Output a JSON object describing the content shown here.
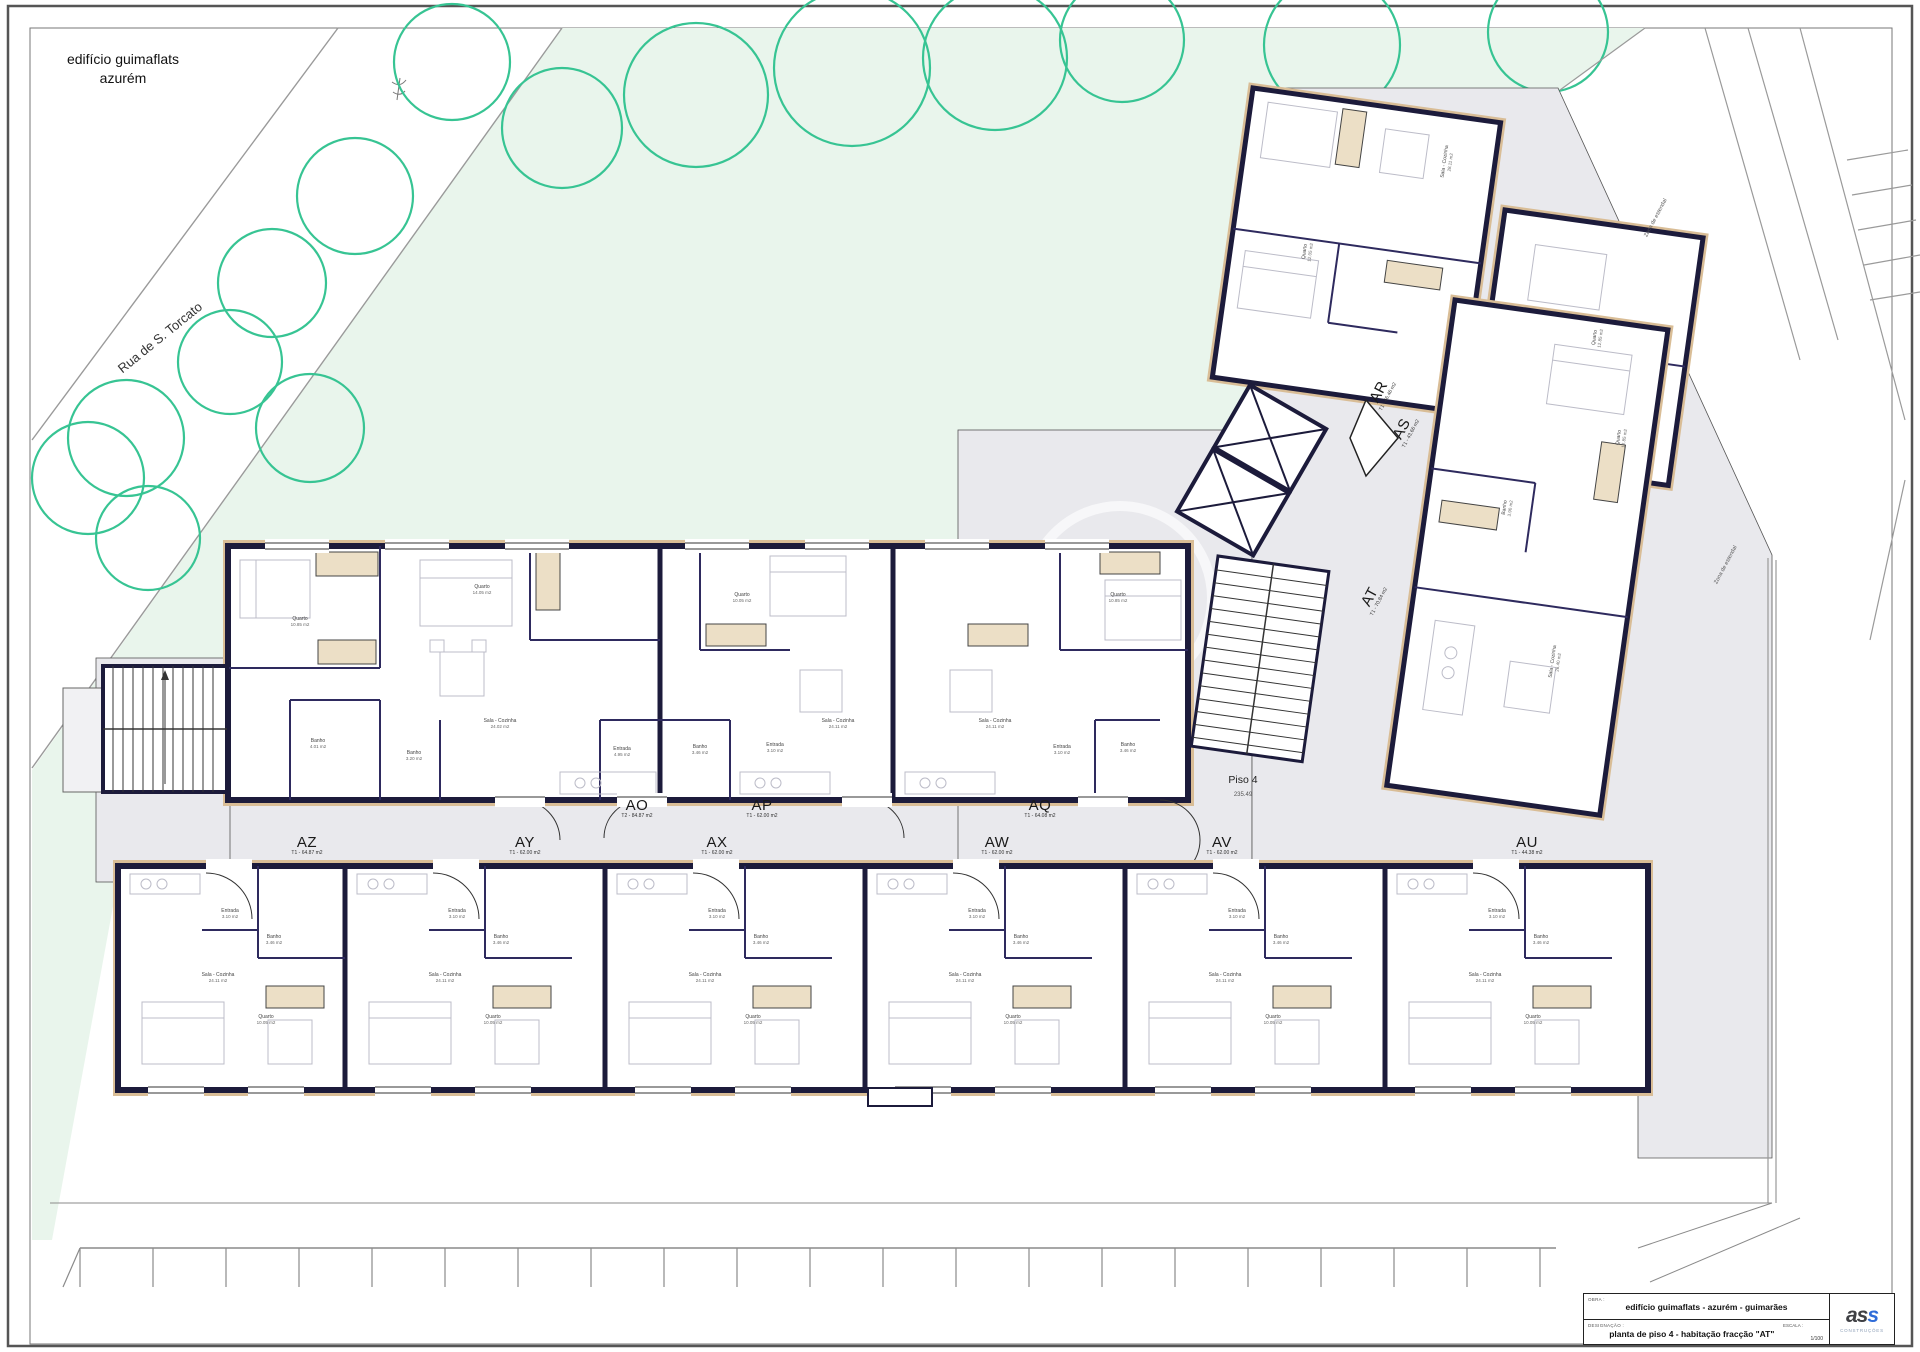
{
  "page": {
    "project_title_line1": "edifício guimaflats",
    "project_title_line2": "azurém",
    "street_name": "Rua de S. Torcato",
    "floor_label": "Piso 4",
    "floor_area": "235.49"
  },
  "colors": {
    "wall": "#1c1b3b",
    "tan": "#d9bd96",
    "gray_deck": "#e9e9ed",
    "green": "#e9f5ec",
    "tree_stroke": "#37c493"
  },
  "units": [
    [
      "AO",
      "T2 - 84.87 m2",
      637,
      808,
      0
    ],
    [
      "AP",
      "T1 - 62.00 m2",
      762,
      808,
      0
    ],
    [
      "AQ",
      "T1 - 64.08 m2",
      1040,
      808,
      0
    ],
    [
      "AZ",
      "T1 - 64.87 m2",
      307,
      845,
      0
    ],
    [
      "AY",
      "T1 - 62.00 m2",
      525,
      845,
      0
    ],
    [
      "AX",
      "T1 - 62.00 m2",
      717,
      845,
      0
    ],
    [
      "AW",
      "T1 - 62.00 m2",
      997,
      845,
      0
    ],
    [
      "AV",
      "T1 - 62.00 m2",
      1222,
      845,
      0
    ],
    [
      "AU",
      "T1 - 44.38 m2",
      1527,
      845,
      0
    ],
    [
      "AR",
      "T1 - 46.46 m2",
      1381,
      393,
      -62
    ],
    [
      "AS",
      "T1 - 43.66 m2",
      1404,
      430,
      -62
    ],
    [
      "AT",
      "T1 - 70.84 m2",
      1372,
      598,
      -62
    ]
  ],
  "rooms": [
    [
      "Quarto",
      "10.85 m2",
      300,
      622,
      0
    ],
    [
      "Quarto",
      "14.05 m2",
      482,
      590,
      0
    ],
    [
      "Sala - Cozinha",
      "24.02 m2",
      500,
      724,
      0
    ],
    [
      "Banho",
      "4.01 m2",
      318,
      744,
      0
    ],
    [
      "Banho",
      "3.20 m2",
      414,
      756,
      0
    ],
    [
      "Entrada",
      "4.95 m2",
      622,
      752,
      0
    ],
    [
      "Quarto",
      "10.05 m2",
      742,
      598,
      0
    ],
    [
      "Sala - Cozinha",
      "24.11 m2",
      838,
      724,
      0
    ],
    [
      "Banho",
      "3.46 m2",
      700,
      750,
      0
    ],
    [
      "Entrada",
      "3.10 m2",
      775,
      748,
      0
    ],
    [
      "Quarto",
      "10.85 m2",
      1118,
      598,
      0
    ],
    [
      "Sala - Cozinha",
      "24.11 m2",
      995,
      724,
      0
    ],
    [
      "Banho",
      "3.46 m2",
      1128,
      748,
      0
    ],
    [
      "Entrada",
      "3.10 m2",
      1062,
      750,
      0
    ],
    [
      "Entrada",
      "3.10 m2",
      230,
      914,
      0
    ],
    [
      "Banho",
      "3.46 m2",
      274,
      940,
      0
    ],
    [
      "Sala - Cozinha",
      "24.11 m2",
      218,
      978,
      0
    ],
    [
      "Quarto",
      "10.05 m2",
      266,
      1020,
      0
    ],
    [
      "Entrada",
      "3.10 m2",
      457,
      914,
      0
    ],
    [
      "Banho",
      "3.46 m2",
      501,
      940,
      0
    ],
    [
      "Sala - Cozinha",
      "24.11 m2",
      445,
      978,
      0
    ],
    [
      "Quarto",
      "10.05 m2",
      493,
      1020,
      0
    ],
    [
      "Entrada",
      "3.10 m2",
      717,
      914,
      0
    ],
    [
      "Banho",
      "3.46 m2",
      761,
      940,
      0
    ],
    [
      "Sala - Cozinha",
      "24.11 m2",
      705,
      978,
      0
    ],
    [
      "Quarto",
      "10.05 m2",
      753,
      1020,
      0
    ],
    [
      "Entrada",
      "3.10 m2",
      977,
      914,
      0
    ],
    [
      "Banho",
      "3.46 m2",
      1021,
      940,
      0
    ],
    [
      "Sala - Cozinha",
      "24.11 m2",
      965,
      978,
      0
    ],
    [
      "Quarto",
      "10.05 m2",
      1013,
      1020,
      0
    ],
    [
      "Entrada",
      "3.10 m2",
      1237,
      914,
      0
    ],
    [
      "Banho",
      "3.46 m2",
      1281,
      940,
      0
    ],
    [
      "Sala - Cozinha",
      "24.11 m2",
      1225,
      978,
      0
    ],
    [
      "Quarto",
      "10.05 m2",
      1273,
      1020,
      0
    ],
    [
      "Entrada",
      "3.10 m2",
      1497,
      914,
      0
    ],
    [
      "Banho",
      "3.46 m2",
      1541,
      940,
      0
    ],
    [
      "Sala - Cozinha",
      "24.11 m2",
      1485,
      978,
      0
    ],
    [
      "Quarto",
      "10.05 m2",
      1533,
      1020,
      0
    ],
    [
      "Sala - Cozinha",
      "28.11 m2",
      1448,
      162,
      -82
    ],
    [
      "Quarto",
      "12.05 m2",
      1308,
      252,
      -82
    ],
    [
      "Quarto",
      "12.85 m2",
      1598,
      338,
      -82
    ],
    [
      "Quarto",
      "12.85 m2",
      1622,
      438,
      -82
    ],
    [
      "Banho",
      "3.90 m2",
      1508,
      508,
      -82
    ],
    [
      "Sala - Cozinha",
      "26.40 m2",
      1556,
      662,
      -82
    ]
  ],
  "terrace_labels": [
    [
      "Zona de estendal",
      1656,
      218
    ],
    [
      "Zona de estendal",
      1726,
      565
    ]
  ],
  "trees": [
    [
      452,
      62,
      58
    ],
    [
      562,
      128,
      60
    ],
    [
      696,
      95,
      72
    ],
    [
      852,
      68,
      78
    ],
    [
      995,
      58,
      72
    ],
    [
      1122,
      40,
      62
    ],
    [
      1332,
      45,
      68
    ],
    [
      1548,
      32,
      60
    ],
    [
      355,
      196,
      58
    ],
    [
      272,
      283,
      54
    ],
    [
      230,
      362,
      52
    ],
    [
      310,
      428,
      54
    ],
    [
      126,
      438,
      58
    ],
    [
      88,
      478,
      56
    ],
    [
      148,
      538,
      52
    ]
  ],
  "title_block": {
    "obra_label": "OBRA :",
    "obra_value": "edifício guimaflats  -  azurém  -  guimarães",
    "designacao_label": "DESIGNAÇÃO :",
    "designacao_value": "planta de piso 4  -  habitação fracção \"AT\"",
    "escala_label": "ESCALA :",
    "escala_value": "1/100",
    "logo_dark": "as",
    "logo_blue": "s",
    "logo_sub": "CONSTRUÇÕES"
  }
}
